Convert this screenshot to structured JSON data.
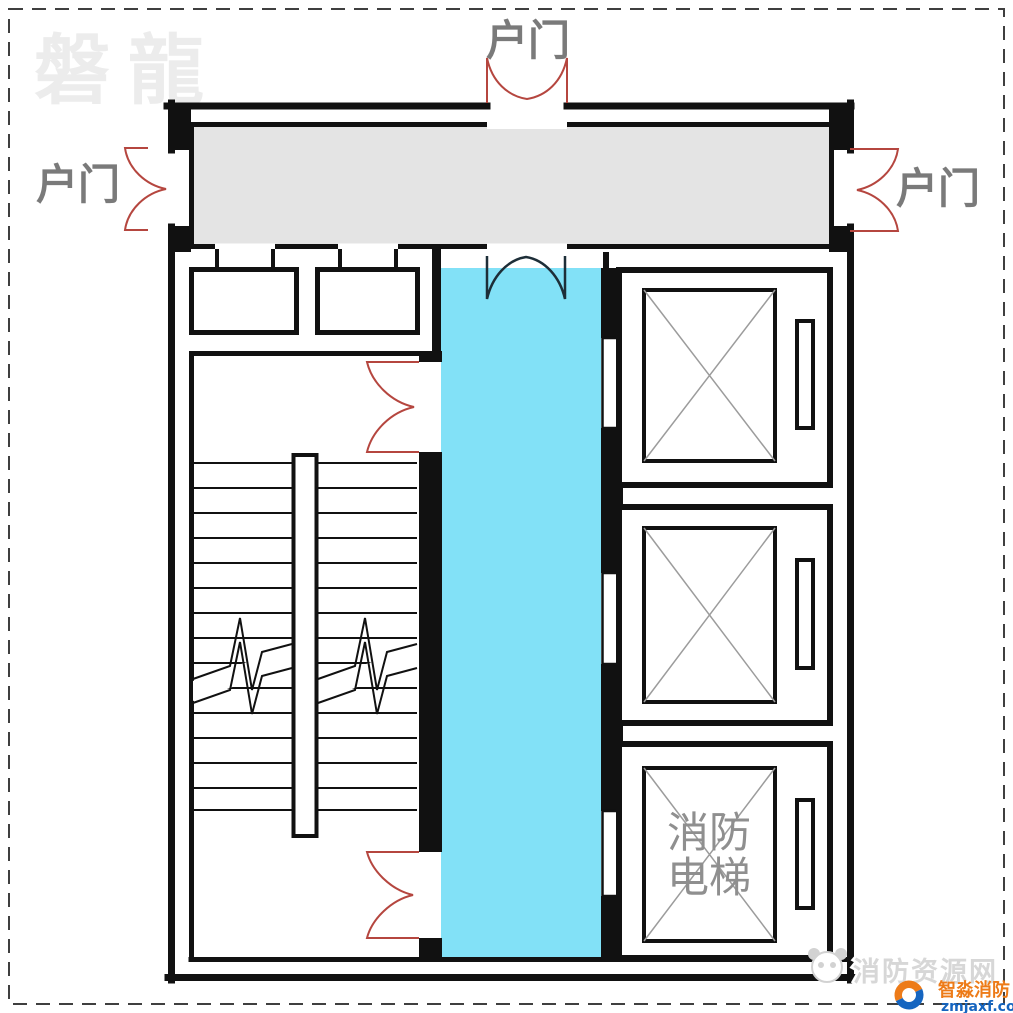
{
  "watermarks": {
    "brand_top_left": "磐龍",
    "site_bottom_right": "消防资源网"
  },
  "door_labels": {
    "left": "户门",
    "top": "户门",
    "right": "户门"
  },
  "fire_elevator_label": {
    "line1": "消防",
    "line2": "电梯"
  },
  "logo": {
    "name": "智淼消防",
    "url_text": "zmjaxf.com"
  },
  "colors": {
    "wall": "#111111",
    "corridor_fill": "#e4e4e4",
    "lobby_fill": "#82e1f7",
    "door_swing_red": "#b5463f",
    "door_swing_dark": "#1d2e38",
    "shaft_diagonal_gray": "#9c9c9c",
    "label_gray": "#7a7a7a",
    "elevator_text_gray": "#8f8f8f",
    "watermark_light": "#ececec",
    "site_watermark_gray": "#d7d7d7",
    "logo_orange": "#ed7b18",
    "logo_blue": "#1565c0",
    "dashed_border": "#3f3f3f"
  }
}
